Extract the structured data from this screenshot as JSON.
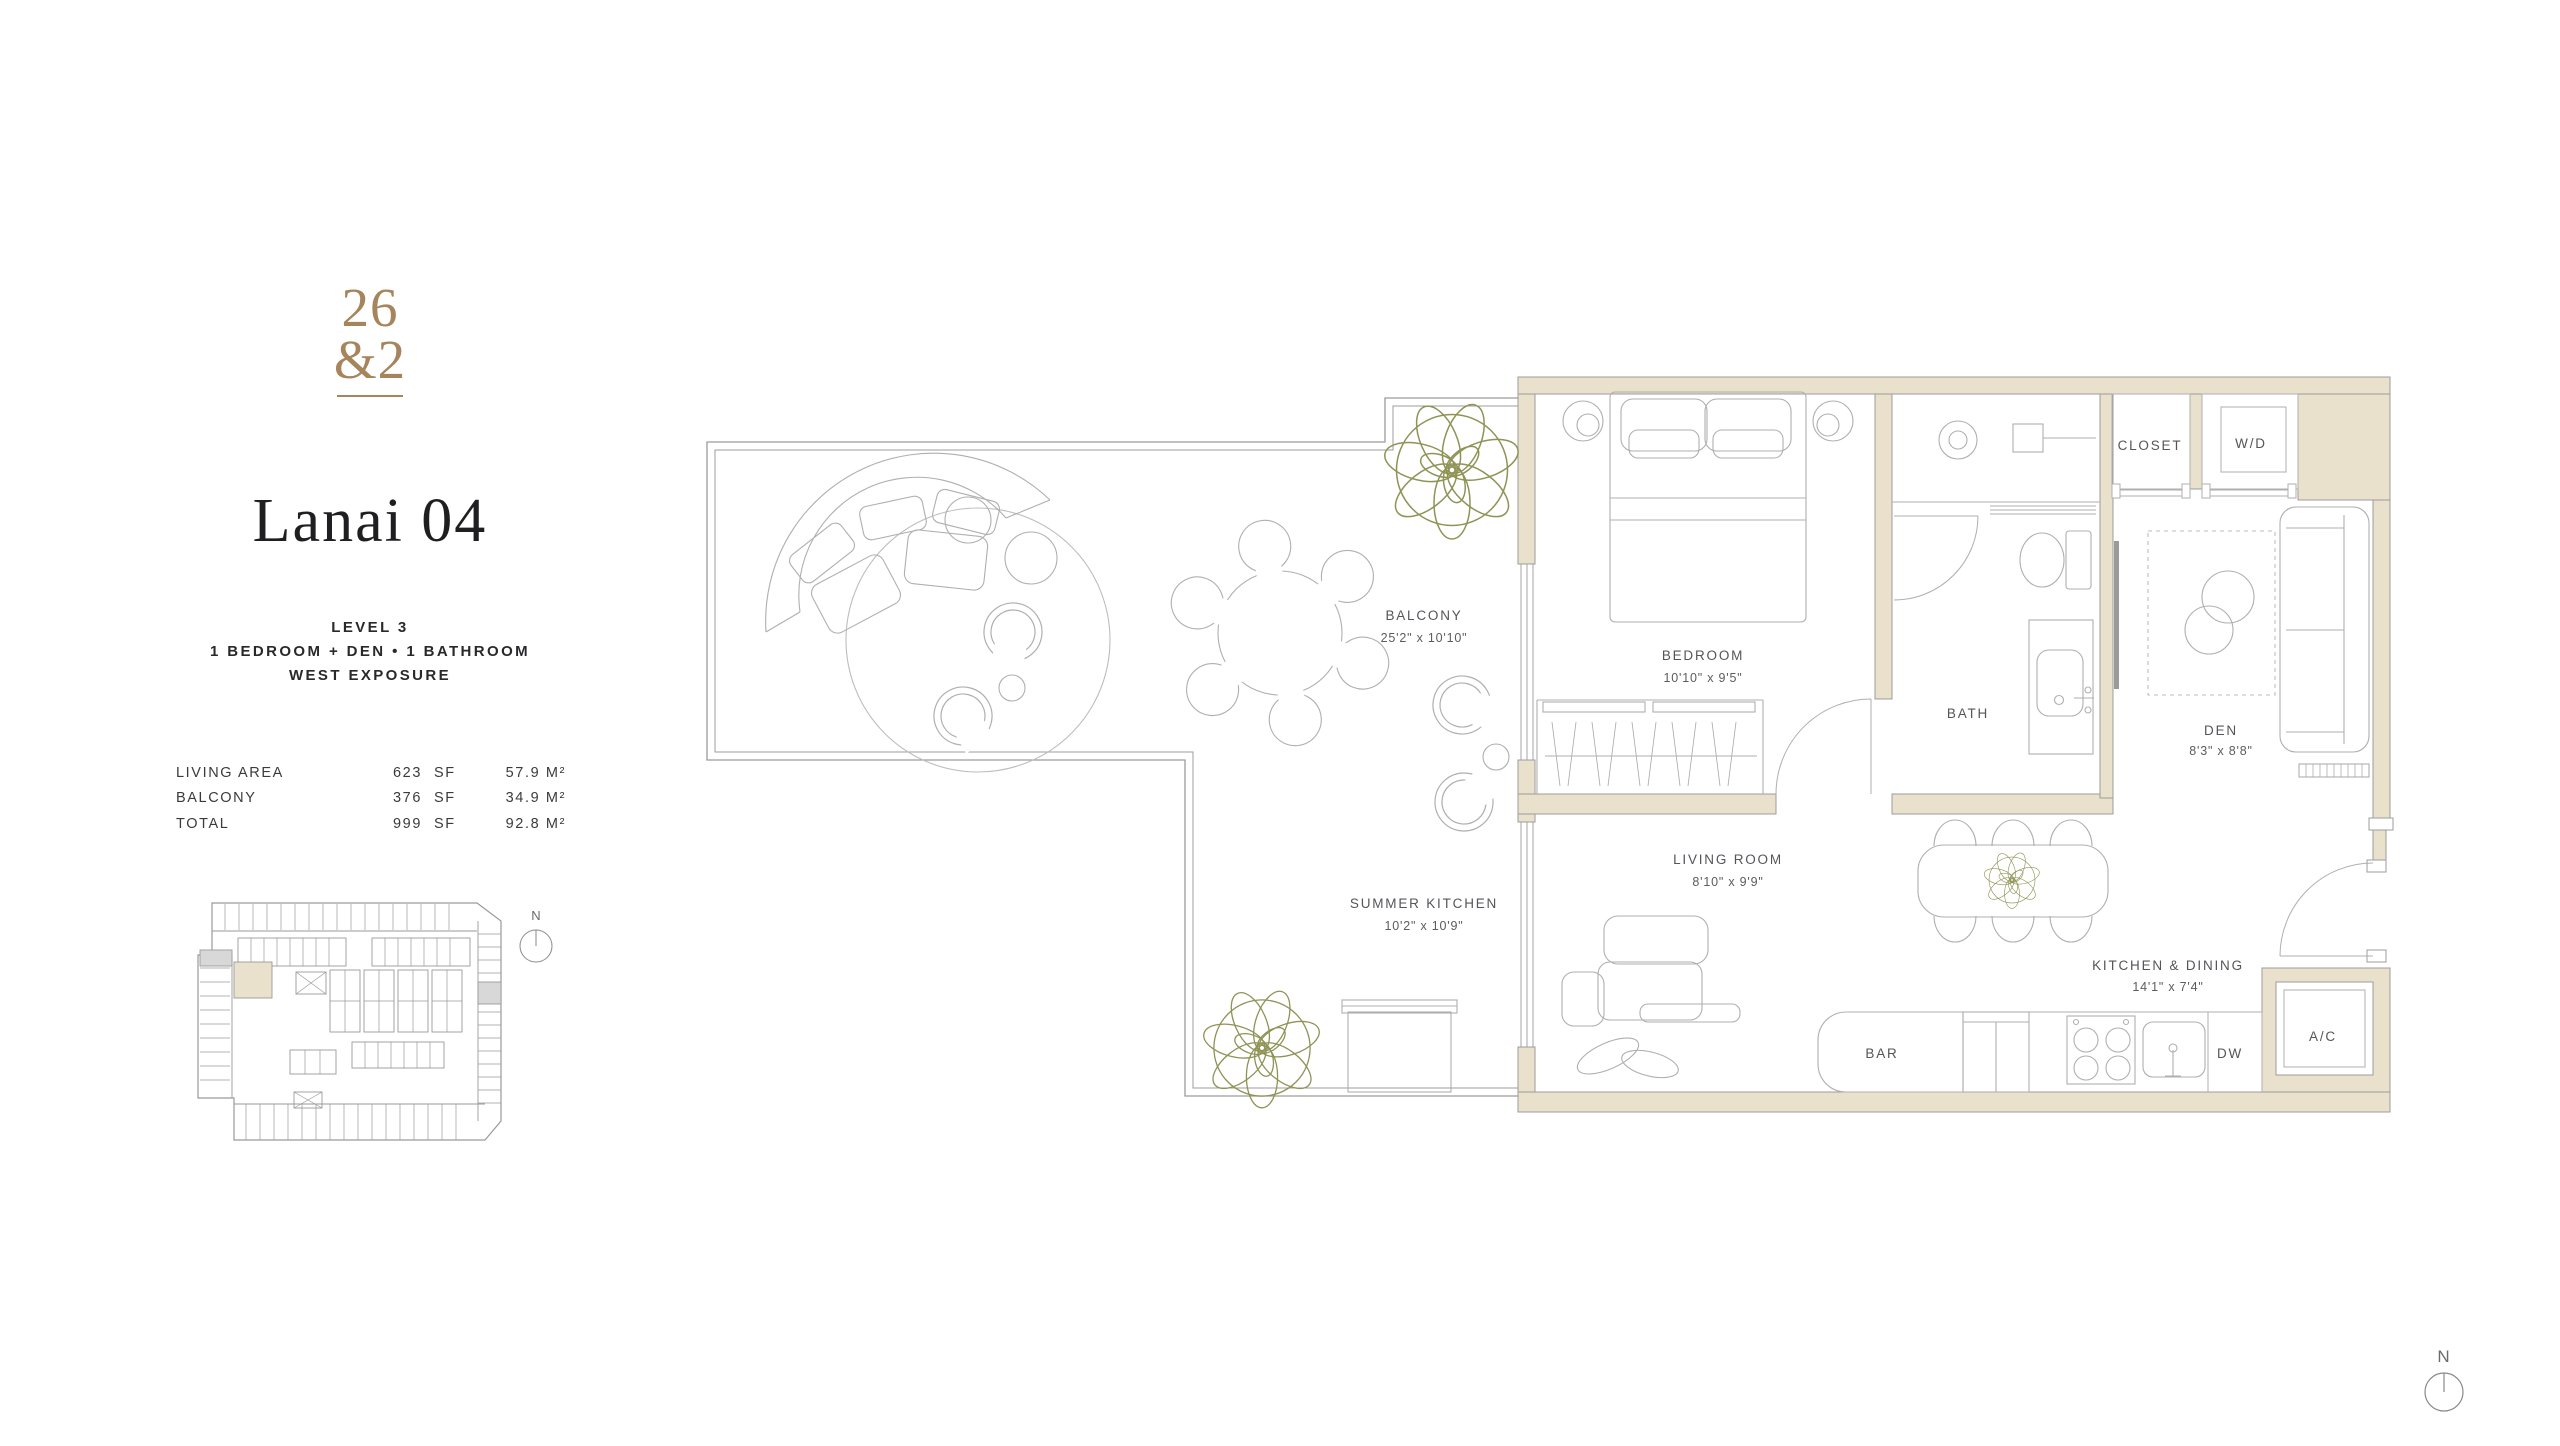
{
  "branding": {
    "logo_top": "26",
    "logo_bottom": "&2"
  },
  "unit": {
    "name": "Lanai 04",
    "level": "LEVEL 3",
    "configuration": "1 BEDROOM + DEN • 1 BATHROOM",
    "exposure": "WEST EXPOSURE"
  },
  "area_table": {
    "rows": [
      {
        "label": "LIVING AREA",
        "value_sf": "623",
        "unit_sf": "SF",
        "value_m2": "57.9 M²"
      },
      {
        "label": "BALCONY",
        "value_sf": "376",
        "unit_sf": "SF",
        "value_m2": "34.9 M²"
      },
      {
        "label": "TOTAL",
        "value_sf": "999",
        "unit_sf": "SF",
        "value_m2": "92.8 M²"
      }
    ]
  },
  "floorplan": {
    "labels": {
      "balcony": {
        "name": "BALCONY",
        "dims": "25'2\" x 10'10\""
      },
      "summer_kitchen": {
        "name": "SUMMER KITCHEN",
        "dims": "10'2\" x 10'9\""
      },
      "bedroom": {
        "name": "BEDROOM",
        "dims": "10'10\" x 9'5\""
      },
      "living_room": {
        "name": "LIVING ROOM",
        "dims": "8'10\" x 9'9\""
      },
      "den": {
        "name": "DEN",
        "dims": "8'3\" x 8'8\""
      },
      "kitchen_dining": {
        "name": "KITCHEN & DINING",
        "dims": "14'1\" x 7'4\""
      },
      "bath": {
        "name": "BATH"
      },
      "closet": {
        "name": "CLOSET"
      },
      "wd": {
        "name": "W/D"
      },
      "bar": {
        "name": "BAR"
      },
      "dw": {
        "name": "DW"
      },
      "ac": {
        "name": "A/C"
      }
    },
    "compass": {
      "label": "N"
    }
  },
  "colors": {
    "wall_fill": "#EAE1CC",
    "line": "#9C9C9C",
    "furniture_line": "#AFAFAF",
    "plant": "#8F9355",
    "brand_accent": "#A6845C",
    "keyplan_gray": "#D8D8D8",
    "text_dark": "#1F1F21"
  }
}
